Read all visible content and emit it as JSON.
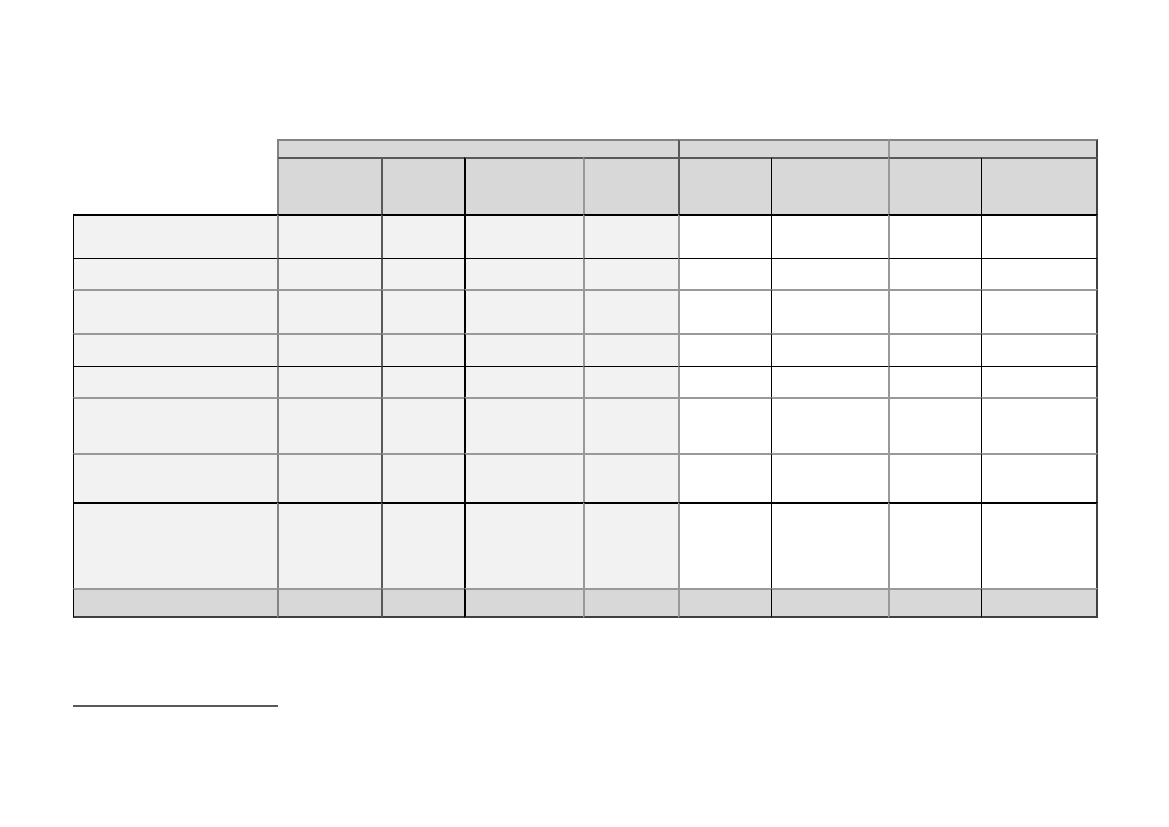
{
  "page": {
    "background": "#ffffff"
  },
  "table": {
    "type": "table",
    "title": "",
    "header": {
      "group_cells": [
        {
          "label": ""
        },
        {
          "label": ""
        },
        {
          "label": ""
        }
      ],
      "column_cells": [
        {
          "label": ""
        },
        {
          "label": ""
        },
        {
          "label": ""
        },
        {
          "label": ""
        },
        {
          "label": ""
        },
        {
          "label": ""
        },
        {
          "label": ""
        },
        {
          "label": ""
        }
      ]
    },
    "body_rows": [
      {
        "row_label": "",
        "cells": [
          "",
          "",
          "",
          "",
          "",
          "",
          "",
          ""
        ]
      },
      {
        "row_label": "",
        "cells": [
          "",
          "",
          "",
          "",
          "",
          "",
          "",
          ""
        ]
      },
      {
        "row_label": "",
        "cells": [
          "",
          "",
          "",
          "",
          "",
          "",
          "",
          ""
        ]
      },
      {
        "row_label": "",
        "cells": [
          "",
          "",
          "",
          "",
          "",
          "",
          "",
          ""
        ]
      },
      {
        "row_label": "",
        "cells": [
          "",
          "",
          "",
          "",
          "",
          "",
          "",
          ""
        ]
      },
      {
        "row_label": "",
        "cells": [
          "",
          "",
          "",
          "",
          "",
          "",
          "",
          ""
        ]
      },
      {
        "row_label": "",
        "cells": [
          "",
          "",
          "",
          "",
          "",
          "",
          "",
          ""
        ]
      },
      {
        "row_label": "",
        "cells": [
          "",
          "",
          "",
          "",
          "",
          "",
          "",
          ""
        ]
      }
    ],
    "footer_row": {
      "row_label": "",
      "cells": [
        "",
        "",
        "",
        "",
        "",
        "",
        "",
        ""
      ]
    },
    "colors": {
      "header_fill": "#d8d8d8",
      "footer_fill": "#d8d8d8",
      "body_shaded_fill": "#f2f2f2",
      "body_plain_fill": "#ffffff",
      "border_black": "#000000",
      "border_gray": "#999999",
      "border_mid_gray": "#838383",
      "border_dark_gray": "#595959",
      "border_edge": "#404040",
      "footnote_rule_color": "#595959",
      "page_bg": "#ffffff"
    }
  },
  "footnote_separator": {
    "text": ""
  }
}
